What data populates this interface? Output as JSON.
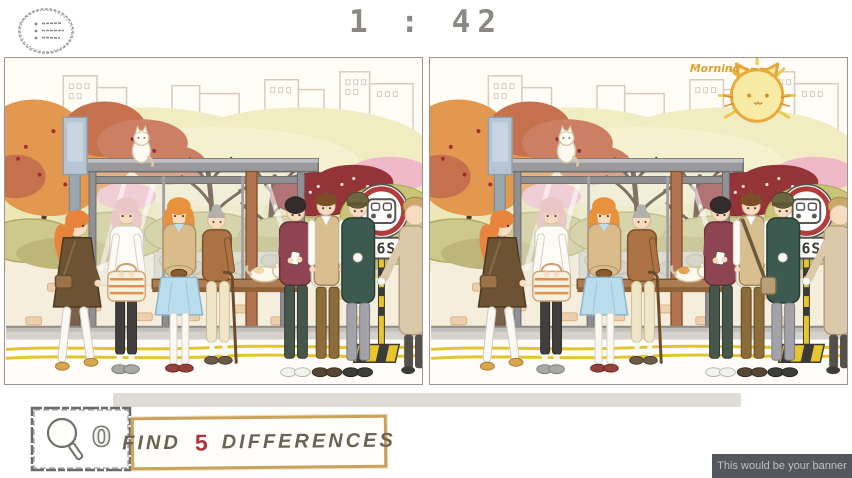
{
  "header": {
    "timer": "1 : 42"
  },
  "icons": {
    "menu": "hamburger-menu-icon",
    "magnifier": "magnifying-glass-icon",
    "bus_sign": "bus-front-icon"
  },
  "game": {
    "found_count": "0",
    "find_label": "FIND",
    "differences_count": "5",
    "differences_label": "DIFFERENCES"
  },
  "scene": {
    "bus_sign_route": "56S",
    "morning_text": "Morning~~~",
    "differences_visible": [
      "morning-sun-cat-doodle",
      "vest-man-shoulder-bag",
      "bench-cat-orange-patch"
    ]
  },
  "banner": {
    "text": "This would be your banner"
  },
  "colors": {
    "timer": "#8b8884",
    "find_box_border": "#c9a35c",
    "differences_number": "#ab3443",
    "banner_bg": "#54575b",
    "banner_text": "#bcc2c9",
    "sign_ring_red": "#b23c3c",
    "road_line_yellow": "#e2c42e",
    "sun_doodle_orange": "#e8a83c"
  }
}
